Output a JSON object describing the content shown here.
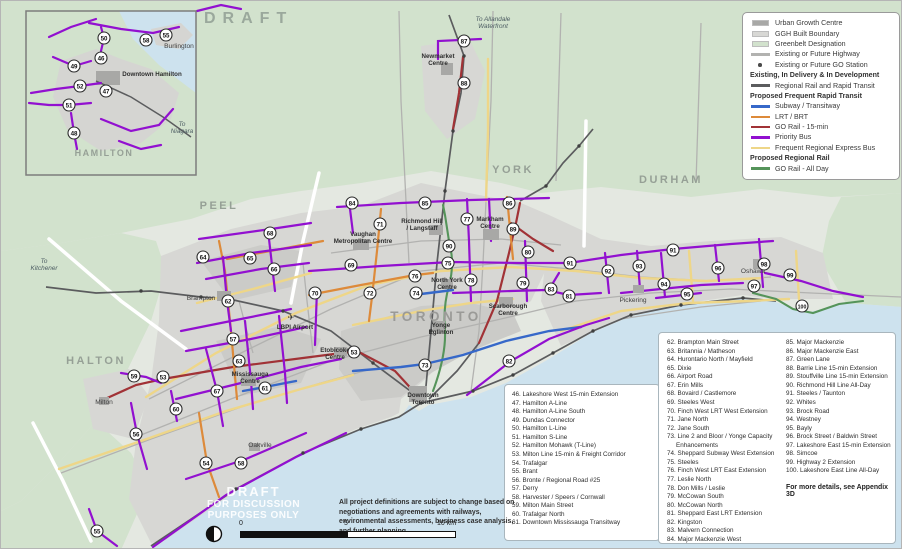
{
  "draft_label": "DRAFT",
  "watermark": [
    "DRAFT",
    "FOR DISCUSSION",
    "PURPOSES ONLY"
  ],
  "legend": {
    "rows": [
      {
        "type": "swatch",
        "color": "#a8a8a6",
        "label": "Urban Growth Centre"
      },
      {
        "type": "swatch",
        "color": "#d8d8d5",
        "label": "GGH Built Boundary"
      },
      {
        "type": "swatch",
        "color": "#d2e2cd",
        "label": "Greenbelt Designation"
      },
      {
        "type": "line",
        "color": "#b2b2b0",
        "label": "Existing or Future Highway"
      },
      {
        "type": "dot",
        "color": "#4a4a4a",
        "label": "Existing or Future GO Station"
      },
      {
        "type": "header",
        "label": "Existing, In Delivery & In Development"
      },
      {
        "type": "line",
        "color": "#5b5c5e",
        "label": "Regional Rail and Rapid Transit"
      },
      {
        "type": "header",
        "label": "Proposed Frequent Rapid Transit"
      },
      {
        "type": "line",
        "color": "#3668c9",
        "label": "Subway / Transitway"
      },
      {
        "type": "line",
        "color": "#dd8a3a",
        "label": "LRT / BRT"
      },
      {
        "type": "line",
        "color": "#a13236",
        "label": "GO Rail - 15-min"
      },
      {
        "type": "line",
        "color": "#9210d0",
        "label": "Priority Bus"
      },
      {
        "type": "line",
        "color": "#eed688",
        "label": "Frequent Regional Express Bus"
      },
      {
        "type": "header",
        "label": "Proposed Regional Rail"
      },
      {
        "type": "line",
        "color": "#55945a",
        "label": "GO Rail - All Day"
      }
    ]
  },
  "project_lists": {
    "list1": [
      "46. Lakeshore West 15-min Extension",
      "47. Hamilton A-Line",
      "48. Hamilton A-Line South",
      "49. Dundas Connector",
      "50. Hamilton L-Line",
      "51. Hamilton S-Line",
      "52. Hamilton Mohawk (T-Line)",
      "53. Milton Line 15-min & Freight Corridor",
      "54. Trafalgar",
      "55. Brant",
      "56. Bronte / Regional Road #25",
      "57. Derry",
      "58. Harvester / Speers / Cornwall",
      "59. Milton Main Street",
      "60. Trafalgar North",
      "61. Downtown Mississauga Transitway"
    ],
    "list2": [
      "62. Brampton Main Street",
      "63. Britannia / Matheson",
      "64. Hurontario North / Mayfield",
      "65. Dixie",
      "66. Airport Road",
      "67. Erin Mills",
      "68. Bovaird / Castlemore",
      "69. Steeles West",
      "70. Finch West LRT West Extension",
      "71. Jane North",
      "72. Jane South",
      "73. Line 2 and Bloor / Yonge Capacity Enhancements",
      "74. Sheppard Subway West Extension",
      "75. Steeles",
      "76. Finch West LRT East Extension",
      "77. Leslie North",
      "78. Don Mills / Leslie",
      "79. McCowan South",
      "80. McCowan North",
      "81. Sheppard East LRT Extension",
      "82. Kingston",
      "83. Malvern Connection",
      "84. Major Mackenzie West"
    ],
    "list3": [
      "85. Major Mackenzie",
      "86. Major Mackenzie East",
      "87. Green Lane",
      "88. Barrie Line 15-min Extension",
      "89. Stouffville Line 15-min Extension",
      "90. Richmond Hill Line All-Day",
      "91. Steeles / Taunton",
      "92. Whites",
      "93. Brock Road",
      "94. Westney",
      "95. Bayly",
      "96. Brock Street / Baldwin Street",
      "97. Lakeshore East 15-min Extension",
      "98. Simcoe",
      "99. Highway 2 Extension",
      "100. Lakeshore East Line All-Day"
    ],
    "more_details": "For more details, see Appendix 3D"
  },
  "note": "All project definitions are subject to change based on negotiations and agreements with railways, environmental assessments, business case analysis, and further planning.",
  "scale": {
    "zero": "0",
    "five": "5",
    "ten": "10 km"
  },
  "map": {
    "markers": [
      {
        "n": "50",
        "x": 103,
        "y": 37
      },
      {
        "n": "58",
        "x": 145,
        "y": 39
      },
      {
        "n": "55",
        "x": 165,
        "y": 34
      },
      {
        "n": "46",
        "x": 100,
        "y": 57
      },
      {
        "n": "49",
        "x": 73,
        "y": 65
      },
      {
        "n": "52",
        "x": 79,
        "y": 85
      },
      {
        "n": "47",
        "x": 105,
        "y": 90
      },
      {
        "n": "51",
        "x": 68,
        "y": 104
      },
      {
        "n": "48",
        "x": 73,
        "y": 132
      },
      {
        "n": "87",
        "x": 463,
        "y": 40
      },
      {
        "n": "88",
        "x": 463,
        "y": 82
      },
      {
        "n": "84",
        "x": 351,
        "y": 202
      },
      {
        "n": "85",
        "x": 424,
        "y": 202
      },
      {
        "n": "86",
        "x": 508,
        "y": 202
      },
      {
        "n": "71",
        "x": 379,
        "y": 223
      },
      {
        "n": "77",
        "x": 466,
        "y": 218
      },
      {
        "n": "89",
        "x": 512,
        "y": 228
      },
      {
        "n": "90",
        "x": 448,
        "y": 245
      },
      {
        "n": "80",
        "x": 527,
        "y": 251
      },
      {
        "n": "64",
        "x": 202,
        "y": 256
      },
      {
        "n": "65",
        "x": 249,
        "y": 257
      },
      {
        "n": "66",
        "x": 273,
        "y": 268
      },
      {
        "n": "68",
        "x": 269,
        "y": 232
      },
      {
        "n": "69",
        "x": 350,
        "y": 264
      },
      {
        "n": "75",
        "x": 447,
        "y": 262
      },
      {
        "n": "62",
        "x": 227,
        "y": 300
      },
      {
        "n": "70",
        "x": 314,
        "y": 292
      },
      {
        "n": "72",
        "x": 369,
        "y": 292
      },
      {
        "n": "74",
        "x": 415,
        "y": 292
      },
      {
        "n": "76",
        "x": 414,
        "y": 275
      },
      {
        "n": "78",
        "x": 470,
        "y": 279
      },
      {
        "n": "79",
        "x": 522,
        "y": 282
      },
      {
        "n": "91",
        "x": 569,
        "y": 262
      },
      {
        "n": "91",
        "x": 672,
        "y": 249
      },
      {
        "n": "92",
        "x": 607,
        "y": 270
      },
      {
        "n": "93",
        "x": 638,
        "y": 265
      },
      {
        "n": "94",
        "x": 663,
        "y": 283
      },
      {
        "n": "95",
        "x": 686,
        "y": 293
      },
      {
        "n": "96",
        "x": 717,
        "y": 267
      },
      {
        "n": "97",
        "x": 753,
        "y": 285
      },
      {
        "n": "98",
        "x": 763,
        "y": 263
      },
      {
        "n": "99",
        "x": 789,
        "y": 274
      },
      {
        "n": "100",
        "x": 801,
        "y": 305
      },
      {
        "n": "81",
        "x": 568,
        "y": 295
      },
      {
        "n": "83",
        "x": 550,
        "y": 288
      },
      {
        "n": "82",
        "x": 508,
        "y": 360
      },
      {
        "n": "73",
        "x": 424,
        "y": 364
      },
      {
        "n": "57",
        "x": 232,
        "y": 338
      },
      {
        "n": "63",
        "x": 238,
        "y": 360
      },
      {
        "n": "61",
        "x": 264,
        "y": 387
      },
      {
        "n": "67",
        "x": 216,
        "y": 390
      },
      {
        "n": "59",
        "x": 133,
        "y": 375
      },
      {
        "n": "53",
        "x": 162,
        "y": 376
      },
      {
        "n": "53",
        "x": 353,
        "y": 351
      },
      {
        "n": "60",
        "x": 175,
        "y": 408
      },
      {
        "n": "54",
        "x": 205,
        "y": 462
      },
      {
        "n": "58",
        "x": 240,
        "y": 462
      },
      {
        "n": "56",
        "x": 135,
        "y": 433
      },
      {
        "n": "55",
        "x": 96,
        "y": 530
      }
    ],
    "labels": [
      {
        "t": "PEEL",
        "x": 218,
        "y": 208,
        "c": "region"
      },
      {
        "t": "YORK",
        "x": 512,
        "y": 172,
        "c": "region"
      },
      {
        "t": "DURHAM",
        "x": 670,
        "y": 182,
        "c": "region"
      },
      {
        "t": "HALTON",
        "x": 95,
        "y": 363,
        "c": "region"
      },
      {
        "t": "TORONTO",
        "x": 435,
        "y": 320,
        "c": "regionbig"
      },
      {
        "t": "HAMILTON",
        "x": 103,
        "y": 155,
        "c": "regionsm"
      },
      {
        "t": "To Allandale\nWaterfront",
        "x": 492,
        "y": 20,
        "c": "dest"
      },
      {
        "t": "To\nKitchener",
        "x": 43,
        "y": 262,
        "c": "dest"
      },
      {
        "t": "To\nNiagara",
        "x": 181,
        "y": 125,
        "c": "dest"
      },
      {
        "t": "Newmarket\nCentre",
        "x": 437,
        "y": 57,
        "c": "place"
      },
      {
        "t": "Brampton",
        "x": 200,
        "y": 299,
        "c": "town"
      },
      {
        "t": "Milton",
        "x": 103,
        "y": 403,
        "c": "town"
      },
      {
        "t": "Oakville",
        "x": 259,
        "y": 446,
        "c": "town"
      },
      {
        "t": "Pickering",
        "x": 632,
        "y": 301,
        "c": "town"
      },
      {
        "t": "Oshawa",
        "x": 752,
        "y": 272,
        "c": "town"
      },
      {
        "t": "Burlington",
        "x": 178,
        "y": 47,
        "c": "town"
      },
      {
        "t": "Downtown Hamilton",
        "x": 151,
        "y": 75,
        "c": "place"
      },
      {
        "t": "Vaughan\nMetropolitan Centre",
        "x": 362,
        "y": 235,
        "c": "place"
      },
      {
        "t": "Richmond Hill\n/ Langstaff",
        "x": 421,
        "y": 222,
        "c": "place"
      },
      {
        "t": "Markham\nCentre",
        "x": 489,
        "y": 220,
        "c": "place"
      },
      {
        "t": "North York\nCentre",
        "x": 446,
        "y": 281,
        "c": "place"
      },
      {
        "t": "Yonge\nEglinton",
        "x": 440,
        "y": 326,
        "c": "place"
      },
      {
        "t": "Scarborough\nCentre",
        "x": 507,
        "y": 307,
        "c": "place"
      },
      {
        "t": "Etobicoke\nCentre",
        "x": 334,
        "y": 351,
        "c": "place"
      },
      {
        "t": "Mississauga\nCentre",
        "x": 249,
        "y": 375,
        "c": "place"
      },
      {
        "t": "✈",
        "x": 290,
        "y": 319,
        "c": "plane"
      },
      {
        "t": "LBPI Airport",
        "x": 294,
        "y": 328,
        "c": "place"
      },
      {
        "t": "Downtown\nToronto",
        "x": 422,
        "y": 396,
        "c": "place"
      }
    ]
  }
}
